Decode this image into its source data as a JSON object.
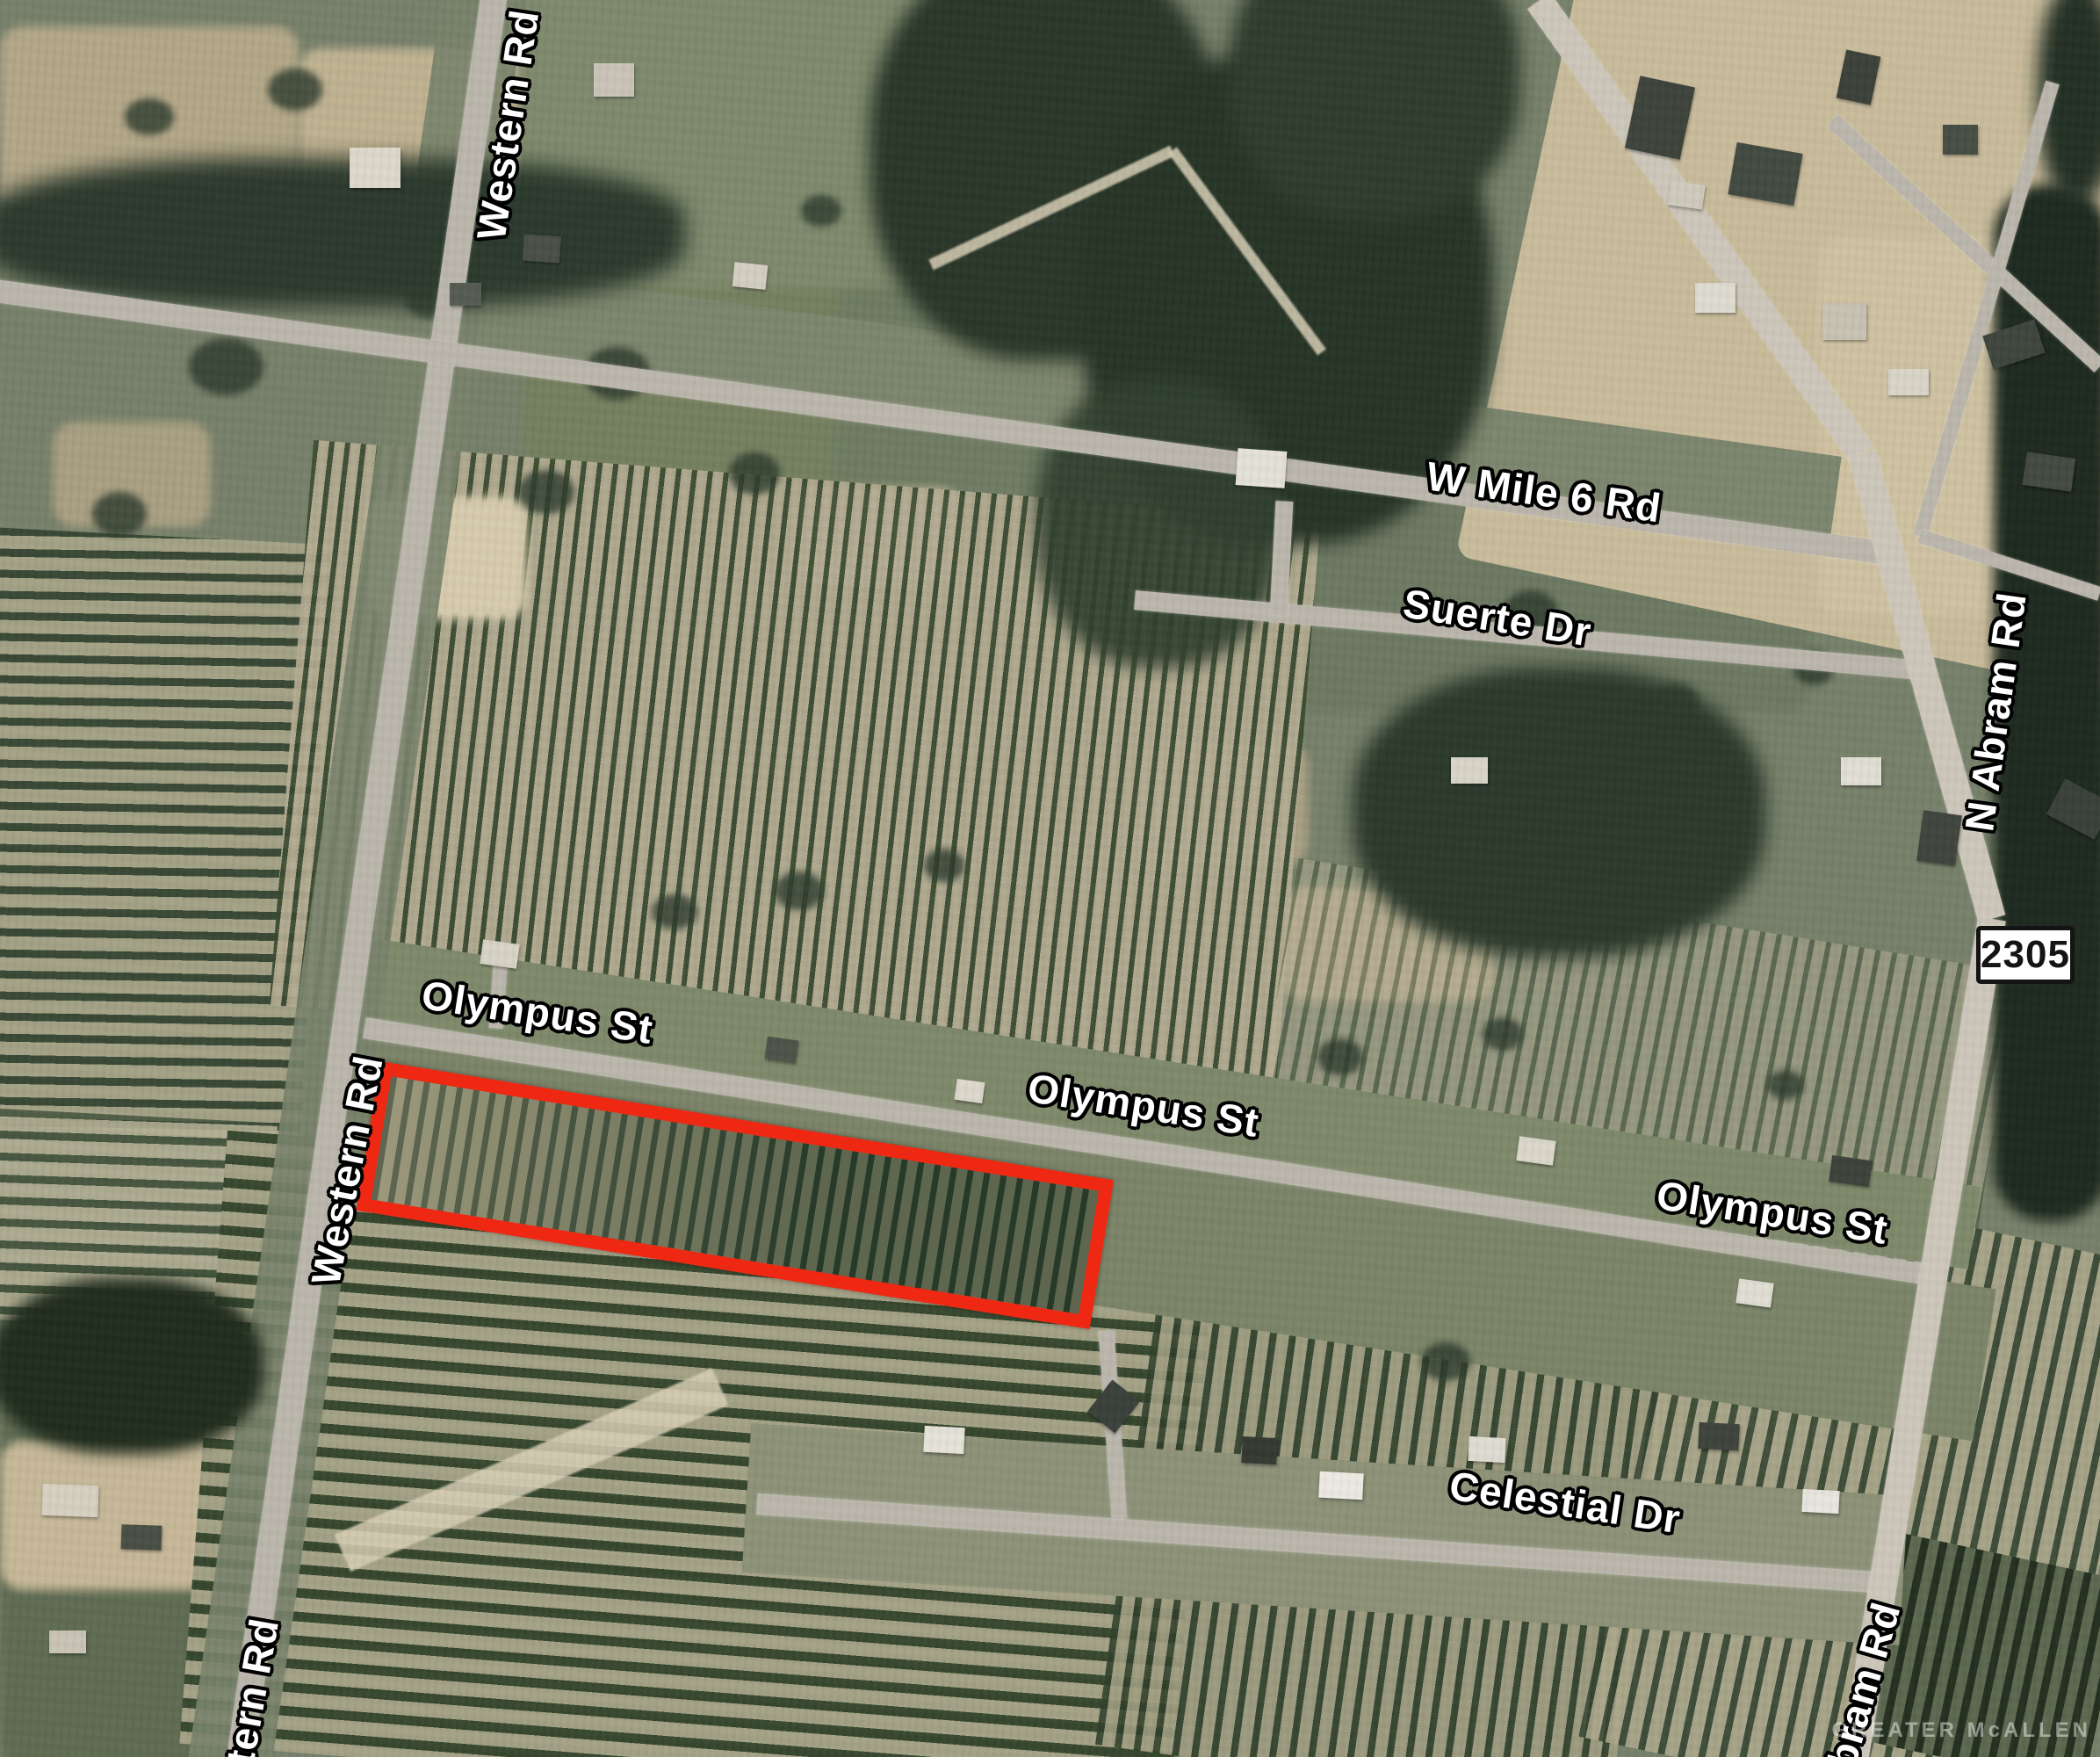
{
  "map": {
    "description": "Satellite aerial map with red-outlined land parcel near Olympus St",
    "colors": {
      "parcel_outline": "#ee2812",
      "road_label_text": "#ffffff",
      "road_label_outline": "#000000",
      "route_badge_background": "#ffffff",
      "route_badge_text": "#141414",
      "road_fill": "#bcb7ad"
    },
    "route_badge": "2305",
    "watermark": "GREATER McALLEN",
    "road_labels": {
      "western_rd_top": "Western Rd",
      "w_mile_6_rd": "W Mile 6 Rd",
      "suerte_dr": "Suerte Dr",
      "n_abram_rd": "N Abram Rd",
      "olympus_st_west": "Olympus St",
      "olympus_st_mid": "Olympus St",
      "olympus_st_east": "Olympus St",
      "western_rd_mid": "Western Rd",
      "celestial_dr": "Celestial Dr",
      "western_rd_bottom_partial": "tern Rd",
      "abram_rd_bottom_partial": "bram Rd"
    }
  }
}
